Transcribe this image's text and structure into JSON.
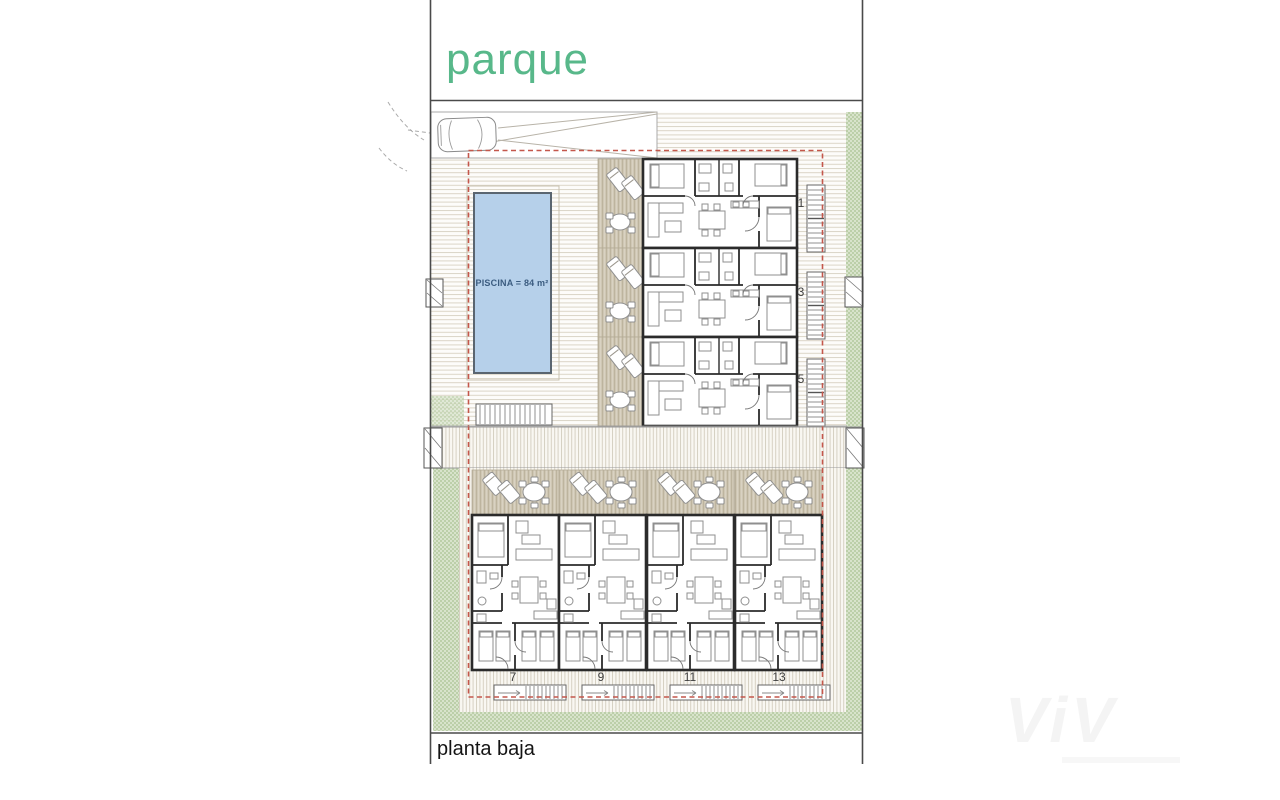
{
  "labels": {
    "park": "parque",
    "pool": "PISCINA = 84 m²",
    "floor": "planta baja",
    "watermark": "ViV"
  },
  "units": {
    "upper": [
      "1",
      "3",
      "5"
    ],
    "lower": [
      "7",
      "9",
      "11",
      "13"
    ]
  },
  "colors": {
    "parque_green": "#58b88a",
    "pool_fill": "#b6d0ea",
    "pool_text": "#3b5c80",
    "boundary_red": "#c4574b",
    "terrace_tan": "#cfc7b4",
    "hedge_green": "#d8e3cb",
    "wall_dark": "#2b2b2b"
  }
}
